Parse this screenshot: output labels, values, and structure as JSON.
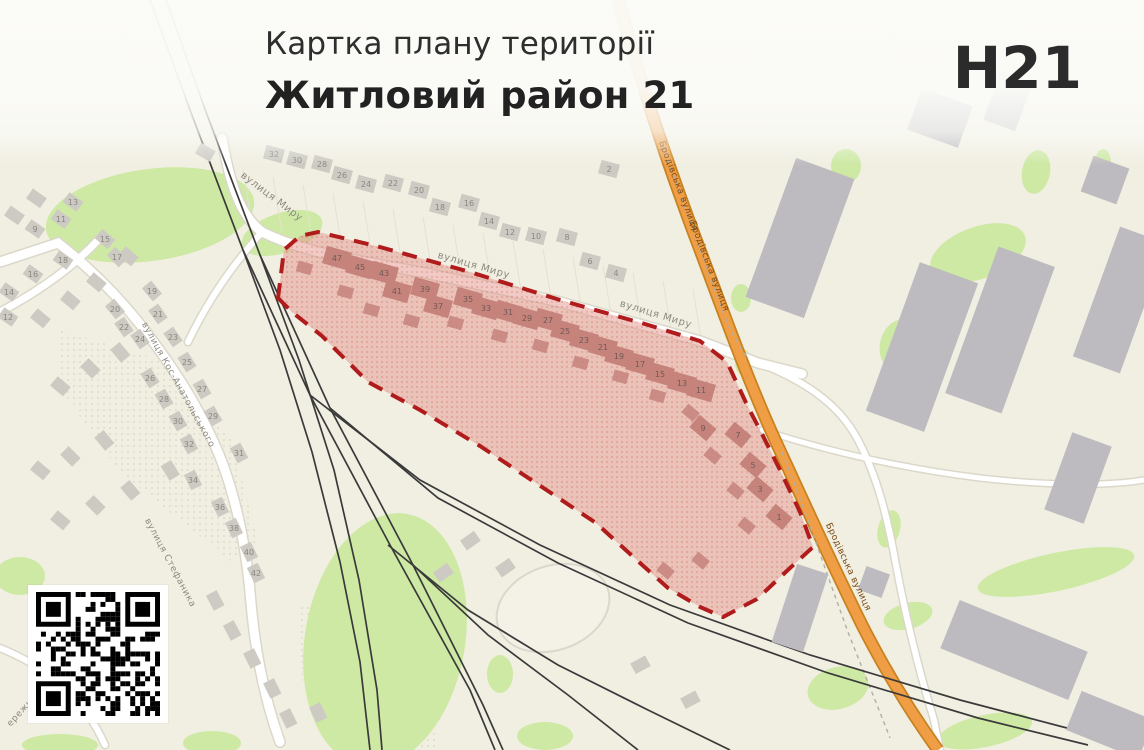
{
  "header": {
    "title": "Картка плану території",
    "subtitle": "Житловий район 21",
    "plate": "H21"
  },
  "colors": {
    "bg": "#f1efe2",
    "green": "#cde9a4",
    "road_casing": "#dbd8ca",
    "road_fill": "#ffffff",
    "orange_fill": "#f09e45",
    "orange_casing": "#c8821f",
    "rail": "#3a3a3a",
    "house": "#cdcac3",
    "industrial": "#bdbbbf",
    "district_fill": "#e59a90",
    "district_border": "#b01b1b",
    "district_building": "#c5837c",
    "label": "#8d8a80",
    "label_orange": "#7a4a14",
    "num": "#8a8781",
    "num_district": "#6f5a54",
    "plot_line": "#e4e1d3",
    "hatch_dot": "#d8d5c2"
  },
  "map": {
    "street_labels": [
      {
        "t": "вулиця Миру",
        "x": 270,
        "y": 199,
        "r": 37,
        "s": 10
      },
      {
        "t": "вулиця Миру",
        "x": 473,
        "y": 268,
        "r": 16,
        "s": 10
      },
      {
        "t": "вулиця Миру",
        "x": 655,
        "y": 317,
        "r": 17,
        "s": 10
      },
      {
        "t": "вулиця Кос-Анатольського",
        "x": 176,
        "y": 386,
        "r": 61,
        "s": 9
      },
      {
        "t": "вулиця Стефаника",
        "x": 168,
        "y": 564,
        "r": 62,
        "s": 9
      },
      {
        "t": "ережна",
        "x": 24,
        "y": 712,
        "r": -48,
        "s": 9
      }
    ],
    "orange_labels": [
      {
        "t": "Бродівська вулиця",
        "x": 676,
        "y": 187,
        "r": 69
      },
      {
        "t": "Бродівська вулиця",
        "x": 707,
        "y": 267,
        "r": 69
      },
      {
        "t": "Бродівська вулиця",
        "x": 846,
        "y": 568,
        "r": 65
      }
    ],
    "orange_road": "M 617,-5 C 640,80 662,148 694,234 C 722,308 746,376 776,442 C 802,498 830,560 862,625 C 886,672 912,714 938,750",
    "roads": [
      {
        "d": "M 222,138 C 230,185 240,215 262,232 C 310,255 360,260 430,274 L 560,302 L 700,341 L 758,363 L 802,374",
        "w": 9
      },
      {
        "d": "M 0,262 L 58,243 C 95,272 125,303 152,340 C 182,380 206,421 222,462 C 238,505 246,550 250,592 C 254,642 262,692 280,742",
        "w": 9
      },
      {
        "d": "M 100,238 C 78,262 45,288 0,312",
        "w": 7
      },
      {
        "d": "M 262,232 C 235,262 208,300 188,342",
        "w": 6
      },
      {
        "d": "M 757,362 C 802,380 838,402 858,440 C 878,478 888,520 896,565 C 906,618 918,668 934,720 L 940,750",
        "w": 6
      },
      {
        "d": "M 762,430 C 830,452 900,468 980,478 C 1050,486 1110,486 1144,480",
        "w": 5
      },
      {
        "d": "M 0,648 C 50,668 85,700 105,745",
        "w": 6
      }
    ],
    "dashed_paths": [
      "M 662,145 C 680,192 700,250 722,310 C 730,330 738,345 748,358",
      "M 782,452 C 806,512 826,572 848,632 C 862,668 876,702 890,738"
    ],
    "railways": [
      "150,0 190,110 243,250 310,395 390,545 470,690 495,750",
      "166,0 206,112 260,255 330,408 413,565 483,705 503,750",
      "243,250 280,350 312,452 340,562 360,662 370,750",
      "260,255 299,360 334,470 359,580 377,690 382,750",
      "310,395 420,480 540,545 670,605 810,655 960,700 1105,738",
      "330,408 438,498 558,563 688,623 828,673 978,718 1088,745",
      "388,545 468,610 558,665 648,710 730,750",
      "413,565 488,635 568,695 638,750"
    ],
    "greens": [
      [
        150,
        215,
        105,
        46,
        -8
      ],
      [
        282,
        233,
        42,
        20,
        -18
      ],
      [
        846,
        166,
        15,
        17,
        0
      ],
      [
        978,
        253,
        50,
        26,
        -20
      ],
      [
        1036,
        172,
        14,
        22,
        10
      ],
      [
        900,
        345,
        20,
        26,
        15
      ],
      [
        741,
        298,
        10,
        14,
        0
      ],
      [
        743,
        362,
        8,
        13,
        0
      ],
      [
        385,
        640,
        80,
        128,
        10
      ],
      [
        500,
        674,
        13,
        19,
        0
      ],
      [
        545,
        736,
        28,
        14,
        0
      ],
      [
        1056,
        572,
        80,
        19,
        -12
      ],
      [
        908,
        616,
        25,
        13,
        -15
      ],
      [
        985,
        731,
        48,
        16,
        -12
      ],
      [
        838,
        688,
        31,
        21,
        -15
      ],
      [
        889,
        529,
        11,
        19,
        15
      ],
      [
        20,
        576,
        25,
        19,
        0
      ],
      [
        60,
        745,
        38,
        11,
        0
      ],
      [
        212,
        743,
        29,
        12,
        0
      ],
      [
        1103,
        163,
        8,
        14,
        0
      ]
    ],
    "hatch_areas": [
      "60,330 160,360 232,440 258,540 232,562 120,472 62,392",
      "300,602 380,642 428,700 438,750 332,750 302,682"
    ],
    "oval": {
      "cx": 553,
      "cy": 608,
      "rx": 58,
      "ry": 42,
      "r": -20
    },
    "industrial": [
      [
        800,
        238,
        62,
        148,
        20
      ],
      [
        922,
        347,
        62,
        158,
        20
      ],
      [
        1000,
        330,
        60,
        156,
        20
      ],
      [
        940,
        118,
        54,
        44,
        20
      ],
      [
        1008,
        101,
        34,
        52,
        20
      ],
      [
        1120,
        300,
        50,
        138,
        20
      ],
      [
        1078,
        478,
        42,
        82,
        20
      ],
      [
        1014,
        650,
        138,
        52,
        22
      ],
      [
        874,
        582,
        25,
        25,
        20
      ],
      [
        800,
        608,
        33,
        82,
        18
      ],
      [
        1110,
        725,
        78,
        42,
        22
      ],
      [
        1105,
        180,
        38,
        38,
        20
      ]
    ],
    "deco_houses": [
      [
        205,
        152,
        30
      ],
      [
        128,
        256,
        40
      ],
      [
        96,
        282,
        40
      ],
      [
        70,
        300,
        40
      ],
      [
        40,
        318,
        40
      ],
      [
        120,
        352,
        50
      ],
      [
        90,
        368,
        45
      ],
      [
        60,
        386,
        40
      ],
      [
        104,
        440,
        50
      ],
      [
        70,
        456,
        45
      ],
      [
        40,
        470,
        40
      ],
      [
        170,
        470,
        58
      ],
      [
        130,
        490,
        50
      ],
      [
        95,
        505,
        45
      ],
      [
        60,
        520,
        40
      ],
      [
        215,
        600,
        62
      ],
      [
        232,
        630,
        62
      ],
      [
        252,
        658,
        64
      ],
      [
        272,
        688,
        64
      ],
      [
        288,
        718,
        64
      ],
      [
        318,
        712,
        64
      ],
      [
        470,
        541,
        -35
      ],
      [
        505,
        568,
        -35
      ],
      [
        443,
        573,
        -35
      ],
      [
        640,
        665,
        -28
      ],
      [
        690,
        700,
        -28
      ],
      [
        36,
        198,
        35
      ],
      [
        14,
        215,
        35
      ]
    ],
    "houses_north": [
      {
        "n": "32",
        "x": 274,
        "y": 154
      },
      {
        "n": "30",
        "x": 297,
        "y": 160
      },
      {
        "n": "28",
        "x": 322,
        "y": 164
      },
      {
        "n": "26",
        "x": 342,
        "y": 175
      },
      {
        "n": "24",
        "x": 366,
        "y": 184
      },
      {
        "n": "22",
        "x": 393,
        "y": 183
      },
      {
        "n": "20",
        "x": 419,
        "y": 190
      },
      {
        "n": "18",
        "x": 440,
        "y": 207
      },
      {
        "n": "16",
        "x": 469,
        "y": 203
      },
      {
        "n": "14",
        "x": 489,
        "y": 221
      },
      {
        "n": "12",
        "x": 510,
        "y": 232
      },
      {
        "n": "10",
        "x": 536,
        "y": 236
      },
      {
        "n": "8",
        "x": 567,
        "y": 237
      },
      {
        "n": "6",
        "x": 590,
        "y": 261
      },
      {
        "n": "4",
        "x": 616,
        "y": 273
      },
      {
        "n": "2",
        "x": 609,
        "y": 169
      }
    ],
    "houses_west": [
      {
        "n": "13",
        "x": 73,
        "y": 202,
        "r": 35
      },
      {
        "n": "11",
        "x": 61,
        "y": 219,
        "r": 35
      },
      {
        "n": "9",
        "x": 35,
        "y": 229,
        "r": 35
      },
      {
        "n": "18",
        "x": 63,
        "y": 260,
        "r": 35
      },
      {
        "n": "16",
        "x": 33,
        "y": 274,
        "r": 35
      },
      {
        "n": "14",
        "x": 9,
        "y": 292,
        "r": 35
      },
      {
        "n": "12",
        "x": 8,
        "y": 317,
        "r": 35
      },
      {
        "n": "15",
        "x": 105,
        "y": 239,
        "r": 40
      },
      {
        "n": "17",
        "x": 117,
        "y": 257,
        "r": 45
      },
      {
        "n": "19",
        "x": 152,
        "y": 291,
        "r": 50
      },
      {
        "n": "20",
        "x": 115,
        "y": 309,
        "r": 50
      },
      {
        "n": "21",
        "x": 158,
        "y": 314,
        "r": 55
      },
      {
        "n": "22",
        "x": 124,
        "y": 327,
        "r": 55
      },
      {
        "n": "23",
        "x": 173,
        "y": 337,
        "r": 55
      },
      {
        "n": "24",
        "x": 140,
        "y": 339,
        "r": 55
      },
      {
        "n": "25",
        "x": 187,
        "y": 362,
        "r": 58
      },
      {
        "n": "26",
        "x": 150,
        "y": 378,
        "r": 58
      },
      {
        "n": "27",
        "x": 202,
        "y": 389,
        "r": 60
      },
      {
        "n": "28",
        "x": 164,
        "y": 399,
        "r": 60
      },
      {
        "n": "29",
        "x": 213,
        "y": 416,
        "r": 60
      },
      {
        "n": "30",
        "x": 178,
        "y": 421,
        "r": 60
      },
      {
        "n": "32",
        "x": 189,
        "y": 444,
        "r": 62
      },
      {
        "n": "31",
        "x": 239,
        "y": 453,
        "r": 62
      },
      {
        "n": "34",
        "x": 193,
        "y": 480,
        "r": 64
      },
      {
        "n": "36",
        "x": 220,
        "y": 507,
        "r": 64
      },
      {
        "n": "38",
        "x": 234,
        "y": 528,
        "r": 64
      },
      {
        "n": "40",
        "x": 249,
        "y": 552,
        "r": 64
      },
      {
        "n": "42",
        "x": 256,
        "y": 573,
        "r": 64
      }
    ],
    "district": {
      "polygon": "278,298 284,250 300,236 318,232 380,247 470,272 560,300 645,324 700,341 727,362 748,407 760,430 780,470 800,512 813,547 790,568 757,599 723,617 700,607 668,588 640,563 596,523 545,489 480,446 420,410 368,382 322,336 292,312",
      "buildings": [
        {
          "n": "47",
          "x": 337,
          "y": 258,
          "r": 16
        },
        {
          "n": "45",
          "x": 360,
          "y": 267,
          "r": 16
        },
        {
          "n": "43",
          "x": 384,
          "y": 273,
          "r": 16
        },
        {
          "n": "41",
          "x": 397,
          "y": 291,
          "r": 16
        },
        {
          "n": "39",
          "x": 425,
          "y": 289,
          "r": 16
        },
        {
          "n": "37",
          "x": 438,
          "y": 306,
          "r": 16
        },
        {
          "n": "35",
          "x": 468,
          "y": 299,
          "r": 16
        },
        {
          "n": "33",
          "x": 486,
          "y": 308,
          "r": 16
        },
        {
          "n": "31",
          "x": 508,
          "y": 312,
          "r": 16
        },
        {
          "n": "29",
          "x": 527,
          "y": 318,
          "r": 16
        },
        {
          "n": "27",
          "x": 548,
          "y": 320,
          "r": 16
        },
        {
          "n": "25",
          "x": 565,
          "y": 331,
          "r": 16
        },
        {
          "n": "23",
          "x": 584,
          "y": 340,
          "r": 16
        },
        {
          "n": "21",
          "x": 603,
          "y": 347,
          "r": 16
        },
        {
          "n": "19",
          "x": 619,
          "y": 356,
          "r": 16
        },
        {
          "n": "17",
          "x": 640,
          "y": 364,
          "r": 16
        },
        {
          "n": "15",
          "x": 660,
          "y": 374,
          "r": 16
        },
        {
          "n": "13",
          "x": 682,
          "y": 383,
          "r": 16
        },
        {
          "n": "11",
          "x": 701,
          "y": 390,
          "r": 16
        },
        {
          "n": "9",
          "x": 703,
          "y": 428,
          "r": 40
        },
        {
          "n": "7",
          "x": 738,
          "y": 435,
          "r": 40
        },
        {
          "n": "5",
          "x": 753,
          "y": 465,
          "r": 40
        },
        {
          "n": "3",
          "x": 760,
          "y": 489,
          "r": 40
        },
        {
          "n": "1",
          "x": 779,
          "y": 517,
          "r": 40
        }
      ],
      "deco": [
        [
          305,
          268,
          16
        ],
        [
          346,
          292,
          16
        ],
        [
          372,
          310,
          16
        ],
        [
          412,
          321,
          16
        ],
        [
          456,
          323,
          16
        ],
        [
          500,
          336,
          16
        ],
        [
          541,
          346,
          16
        ],
        [
          581,
          363,
          16
        ],
        [
          621,
          377,
          16
        ],
        [
          658,
          396,
          16
        ],
        [
          691,
          413,
          40
        ],
        [
          713,
          456,
          40
        ],
        [
          736,
          491,
          40
        ],
        [
          747,
          526,
          40
        ],
        [
          701,
          561,
          40
        ],
        [
          666,
          571,
          40
        ]
      ]
    },
    "plot_strip": {
      "x0": 252,
      "x1": 705,
      "step": 30
    },
    "qr_seed": 42
  }
}
